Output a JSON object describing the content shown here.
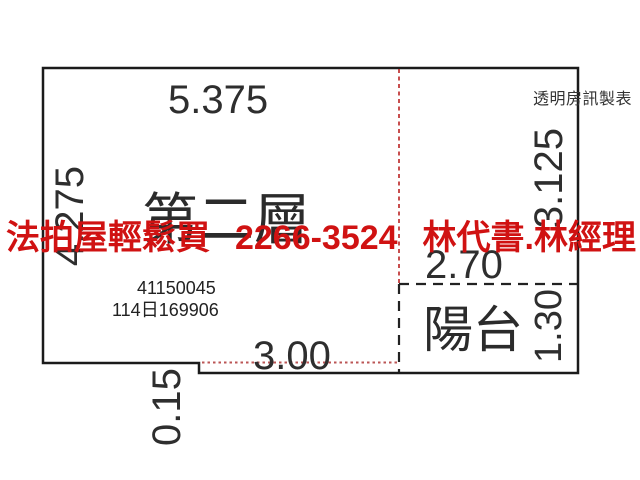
{
  "maker_label": "透明房訊製表",
  "plan": {
    "floor_label": "第二層",
    "balcony_label": "陽台",
    "registry_numbers": [
      "41150045",
      "114日169906"
    ],
    "dimensions": {
      "top_width": "5.375",
      "left_height": "4.275",
      "right_height": "3.125",
      "inner_room_width": "2.70",
      "balcony_depth": "1.30",
      "bottom_width": "3.00",
      "step_depth": "0.15"
    }
  },
  "ad_banner": {
    "slogan": "法拍屋輕鬆買",
    "phone": "2266-3524",
    "contact": "林代書.林經理"
  },
  "colors": {
    "outline": "#1b1b1b",
    "dashed_line": "#222222",
    "red_partition_line": "#bb2222",
    "red_dotted_line": "#bb5555",
    "banner_red": "#d01212",
    "text": "#2e2e2e"
  }
}
